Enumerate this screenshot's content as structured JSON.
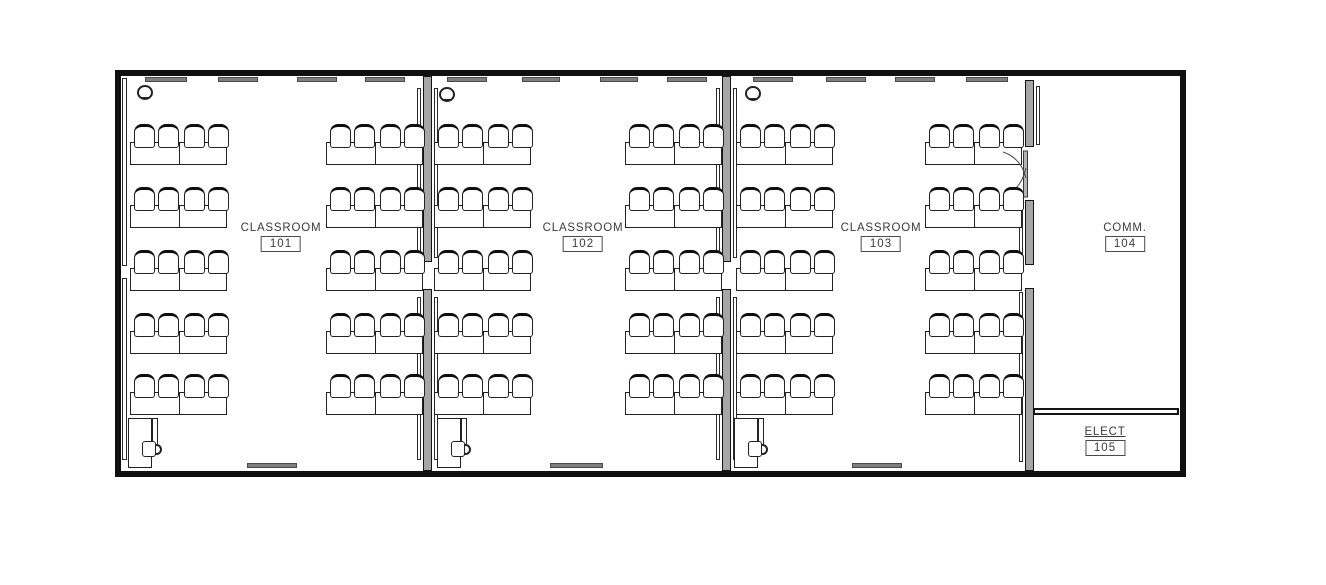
{
  "drawing": {
    "type": "architectural-floor-plan",
    "description": "Single-storey building plan with three classrooms, a communications room and an electrical room"
  },
  "rooms": [
    {
      "name": "CLASSROOM",
      "number": "101"
    },
    {
      "name": "CLASSROOM",
      "number": "102"
    },
    {
      "name": "CLASSROOM",
      "number": "103"
    },
    {
      "name": "COMM.",
      "number": "104"
    },
    {
      "name": "ELECT",
      "number": "105"
    }
  ],
  "colors": {
    "line": "#141414",
    "wall_fill": "#a6a6a6",
    "bar_fill": "#7e7e7e",
    "background": "#ffffff"
  },
  "floorplan": {
    "exterior": {
      "x": 115,
      "y": 70,
      "w": 1071,
      "h": 407,
      "t": 6
    },
    "walls": [
      {
        "x": 423,
        "w": 9,
        "segs": [
          [
            76,
            262
          ],
          [
            289,
            471
          ]
        ],
        "boards_left": [
          [
            88,
            258
          ],
          [
            297,
            460
          ]
        ],
        "boards_right": [
          [
            88,
            258
          ],
          [
            297,
            460
          ]
        ]
      },
      {
        "x": 722,
        "w": 9,
        "segs": [
          [
            76,
            262
          ],
          [
            289,
            471
          ]
        ],
        "boards_left": [
          [
            88,
            258
          ],
          [
            297,
            460
          ]
        ],
        "boards_right": [
          [
            88,
            258
          ],
          [
            297,
            460
          ]
        ]
      },
      {
        "x": 1025,
        "w": 9,
        "segs": [
          [
            80,
            147
          ],
          [
            200,
            265
          ],
          [
            288,
            471
          ]
        ],
        "boards_left": [
          [
            204,
            262
          ],
          [
            292,
            462
          ]
        ],
        "boards_right": [
          [
            86,
            145
          ]
        ]
      }
    ],
    "left_wall_boards": {
      "x": 122,
      "w": 5,
      "segs": [
        [
          78,
          266
        ],
        [
          278,
          460
        ]
      ]
    },
    "elect_wall": {
      "x": 1033,
      "y": 408,
      "w": 146,
      "h": 7
    },
    "classrooms": [
      {
        "clusters_x": [
          130,
          326
        ],
        "teacher_desk_x": 128,
        "symbol": [
          137,
          85
        ],
        "top_bars": [
          [
            145,
            42
          ],
          [
            218,
            40
          ],
          [
            297,
            40
          ],
          [
            365,
            40
          ]
        ],
        "bottom_bar": [
          247,
          50
        ]
      },
      {
        "clusters_x": [
          434,
          625
        ],
        "teacher_desk_x": 437,
        "symbol": [
          439,
          87
        ],
        "top_bars": [
          [
            447,
            40
          ],
          [
            522,
            38
          ],
          [
            600,
            38
          ],
          [
            667,
            40
          ]
        ],
        "bottom_bar": [
          550,
          53
        ]
      },
      {
        "clusters_x": [
          736,
          925
        ],
        "teacher_desk_x": 734,
        "symbol": [
          745,
          86
        ],
        "top_bars": [
          [
            753,
            40
          ],
          [
            826,
            40
          ],
          [
            895,
            40
          ],
          [
            966,
            42
          ]
        ],
        "bottom_bar": [
          852,
          50
        ]
      }
    ],
    "desk_rows_table_y": [
      142,
      205,
      268,
      331,
      392
    ],
    "cluster": {
      "w": 97,
      "table_h": 23,
      "chair_w": 21,
      "chair_h": 24,
      "chair_offsets": [
        4,
        28,
        54,
        78
      ],
      "chair_rise": 18
    },
    "top_bar": {
      "y": 77,
      "h": 5
    },
    "bottom_bar": {
      "y": 463,
      "h": 5
    },
    "teacher_desk": {
      "y": 418,
      "main_w": 24,
      "main_h": 50,
      "return_w": 6,
      "return_h": 28
    },
    "labels": [
      {
        "cx": 281,
        "top": 222
      },
      {
        "cx": 583,
        "top": 222
      },
      {
        "cx": 881,
        "top": 222
      },
      {
        "cx": 1125,
        "top": 222
      },
      {
        "cx": 1105,
        "top": 426
      }
    ],
    "door": {
      "leaf": {
        "x": 1023.5,
        "y": 151,
        "w": 4,
        "h": 46
      },
      "arcs": [
        "M 1003 152 Q 1021 158 1026 178",
        "M 1003 196 Q 1021 190 1026 168"
      ]
    }
  }
}
